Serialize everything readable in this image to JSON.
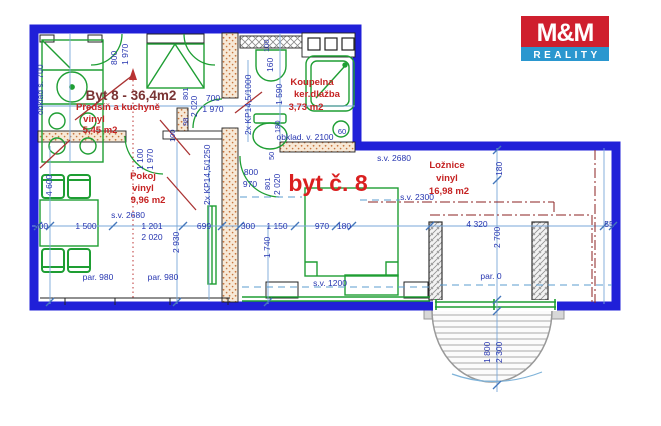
{
  "logo": {
    "brand": "M&M",
    "subtitle": "REALITY",
    "brand_bg": "#cf1f2e",
    "subtitle_bg": "#2a97cf"
  },
  "plan": {
    "title": "Byt 8 - 36,4m2",
    "unit_label": "byt č. 8",
    "rooms": [
      {
        "name": "Předsíň a kuchyně",
        "floor": "vinyl",
        "area": "5,45 m2"
      },
      {
        "name": "Koupelna",
        "floor": "ker.dlažba",
        "area": "3,73 m2"
      },
      {
        "name": "Pokoj",
        "floor": "vinyl",
        "area": "9,96 m2"
      },
      {
        "name": "Ložnice",
        "floor": "vinyl",
        "area": "16,98 m2"
      }
    ],
    "colors": {
      "outline_blue": "#2020d8",
      "furniture_green": "#1e9e33",
      "dimension_blue": "#2635b0",
      "room_label_red": "#c52323",
      "unit_label_red": "#da2020"
    },
    "labels": [
      {
        "n": "plan-title",
        "t": "Byt 8 - 36,4m2",
        "x": 131,
        "y": 100,
        "cls": "title",
        "a": "middle"
      },
      {
        "n": "room-hall-name",
        "t": "Předsíň a kuchyně",
        "x": 118,
        "y": 110,
        "cls": "room",
        "a": "middle"
      },
      {
        "n": "room-hall-floor",
        "t": "vinyl",
        "x": 94,
        "y": 122,
        "cls": "room",
        "a": "middle"
      },
      {
        "n": "room-hall-area",
        "t": "5,45 m2",
        "x": 100,
        "y": 133,
        "cls": "room",
        "a": "middle"
      },
      {
        "n": "room-bath-name",
        "t": "Koupelna",
        "x": 312,
        "y": 85,
        "cls": "room",
        "a": "middle"
      },
      {
        "n": "room-bath-floor",
        "t": "ker.dlažba",
        "x": 317,
        "y": 97,
        "cls": "room",
        "a": "middle"
      },
      {
        "n": "room-bath-area",
        "t": "3,73 m2",
        "x": 306,
        "y": 110,
        "cls": "room",
        "a": "middle"
      },
      {
        "n": "room-pokoj-name",
        "t": "Pokoj",
        "x": 143,
        "y": 179,
        "cls": "room",
        "a": "middle"
      },
      {
        "n": "room-pokoj-floor",
        "t": "vinyl",
        "x": 143,
        "y": 191,
        "cls": "room",
        "a": "middle"
      },
      {
        "n": "room-pokoj-area",
        "t": "9,96 m2",
        "x": 148,
        "y": 203,
        "cls": "room",
        "a": "middle"
      },
      {
        "n": "unit-label",
        "t": "byt č. 8",
        "x": 328,
        "y": 191,
        "cls": "unit",
        "a": "middle"
      },
      {
        "n": "room-loznice-name",
        "t": "Ložnice",
        "x": 447,
        "y": 168,
        "cls": "room",
        "a": "middle"
      },
      {
        "n": "room-loznice-floor",
        "t": "vinyl",
        "x": 447,
        "y": 181,
        "cls": "room",
        "a": "middle"
      },
      {
        "n": "room-loznice-area",
        "t": "16,98 m2",
        "x": 449,
        "y": 194,
        "cls": "room",
        "a": "middle"
      },
      {
        "n": "dim-label",
        "t": "700",
        "x": 213,
        "y": 101,
        "a": "middle"
      },
      {
        "n": "dim-label",
        "t": "1 970",
        "x": 213,
        "y": 112,
        "a": "middle"
      },
      {
        "n": "dim-label",
        "t": "obklad. v. 2100",
        "x": 305,
        "y": 140,
        "a": "middle"
      },
      {
        "n": "dim-label",
        "t": "s.v. 2680",
        "x": 128,
        "y": 218,
        "a": "middle"
      },
      {
        "n": "dim-label",
        "t": "300",
        "x": 41,
        "y": 229,
        "a": "middle"
      },
      {
        "n": "dim-label",
        "t": "1 500",
        "x": 86,
        "y": 229,
        "a": "middle"
      },
      {
        "n": "dim-label",
        "t": "1 201",
        "x": 152,
        "y": 229,
        "a": "middle"
      },
      {
        "n": "dim-label",
        "t": "2 020",
        "x": 152,
        "y": 240,
        "a": "middle"
      },
      {
        "n": "dim-label",
        "t": "699",
        "x": 204,
        "y": 229,
        "a": "middle"
      },
      {
        "n": "dim-label",
        "t": "300",
        "x": 248,
        "y": 229,
        "a": "middle"
      },
      {
        "n": "dim-label",
        "t": "1 150",
        "x": 277,
        "y": 229,
        "a": "middle"
      },
      {
        "n": "dim-label",
        "t": "970",
        "x": 322,
        "y": 229,
        "a": "middle"
      },
      {
        "n": "dim-label",
        "t": "180",
        "x": 344,
        "y": 229,
        "a": "middle"
      },
      {
        "n": "dim-label",
        "t": "par. 980",
        "x": 98,
        "y": 280,
        "a": "middle"
      },
      {
        "n": "dim-label",
        "t": "par. 980",
        "x": 163,
        "y": 280,
        "a": "middle"
      },
      {
        "n": "dim-label",
        "t": "800",
        "x": 251,
        "y": 175,
        "a": "middle"
      },
      {
        "n": "dim-label",
        "t": "970",
        "x": 250,
        "y": 187,
        "a": "middle"
      },
      {
        "n": "dim-label",
        "t": "s.v. 2680",
        "x": 394,
        "y": 161,
        "a": "middle"
      },
      {
        "n": "dim-label",
        "t": "s.v. 2300",
        "x": 417,
        "y": 200,
        "a": "middle"
      },
      {
        "n": "dim-label",
        "t": "4 320",
        "x": 477,
        "y": 227,
        "a": "middle"
      },
      {
        "n": "dim-label",
        "t": "55",
        "x": 609,
        "y": 227,
        "a": "middle"
      },
      {
        "n": "dim-label",
        "t": "par. 0",
        "x": 491,
        "y": 279,
        "a": "middle"
      },
      {
        "n": "dim-label",
        "t": "s.v. 1200",
        "x": 330,
        "y": 286,
        "a": "middle"
      },
      {
        "n": "dim-label",
        "t": "60",
        "x": 342,
        "y": 134,
        "a": "middle",
        "cls": "dimsm"
      },
      {
        "n": "dim-label",
        "t": "800",
        "x": 117,
        "y": 65,
        "r": -90
      },
      {
        "n": "dim-label",
        "t": "1 970",
        "x": 128,
        "y": 65,
        "r": -90
      },
      {
        "n": "dim-label",
        "t": "2 020",
        "x": 197,
        "y": 117,
        "r": -90
      },
      {
        "n": "dim-label",
        "t": "801",
        "x": 188,
        "y": 100,
        "r": -90,
        "cls": "dimsm"
      },
      {
        "n": "dim-label",
        "t": "98",
        "x": 188,
        "y": 126,
        "r": -90,
        "cls": "dimsm"
      },
      {
        "n": "dim-label",
        "t": "100",
        "x": 175,
        "y": 142,
        "r": -90,
        "cls": "dimsm"
      },
      {
        "n": "dim-label",
        "t": "100",
        "x": 269,
        "y": 52,
        "r": -90,
        "cls": "dimsm"
      },
      {
        "n": "dim-label",
        "t": "160",
        "x": 273,
        "y": 72,
        "r": -90
      },
      {
        "n": "dim-label",
        "t": "1 590",
        "x": 282,
        "y": 105,
        "r": -90
      },
      {
        "n": "dim-label",
        "t": "2x KP14,5/1000",
        "x": 251,
        "y": 135,
        "r": -90
      },
      {
        "n": "dim-label",
        "t": "180",
        "x": 280,
        "y": 133,
        "r": -90,
        "cls": "dimsm"
      },
      {
        "n": "dim-label",
        "t": "obklad š. 700",
        "x": 43,
        "y": 115,
        "r": -90
      },
      {
        "n": "dim-label",
        "t": "1 100",
        "x": 143,
        "y": 170,
        "r": -90
      },
      {
        "n": "dim-label",
        "t": "1 970",
        "x": 153,
        "y": 170,
        "r": -90
      },
      {
        "n": "dim-label",
        "t": "2x KP14,5/1250",
        "x": 210,
        "y": 205,
        "r": -90
      },
      {
        "n": "dim-label",
        "t": "4 600",
        "x": 52,
        "y": 196,
        "r": -90
      },
      {
        "n": "dim-label",
        "t": "2 930",
        "x": 179,
        "y": 253,
        "r": -90
      },
      {
        "n": "dim-label",
        "t": "1 740",
        "x": 270,
        "y": 258,
        "r": -90
      },
      {
        "n": "dim-label",
        "t": "50",
        "x": 274,
        "y": 160,
        "r": -90,
        "cls": "dimsm"
      },
      {
        "n": "dim-label",
        "t": "801",
        "x": 270,
        "y": 190,
        "r": -90,
        "cls": "dimsm"
      },
      {
        "n": "dim-label",
        "t": "2 020",
        "x": 280,
        "y": 195,
        "r": -90
      },
      {
        "n": "dim-label",
        "t": "180",
        "x": 502,
        "y": 176,
        "r": -90
      },
      {
        "n": "dim-label",
        "t": "2 700",
        "x": 500,
        "y": 248,
        "r": -90
      },
      {
        "n": "dim-label",
        "t": "1 800",
        "x": 490,
        "y": 363,
        "r": -90
      },
      {
        "n": "dim-label",
        "t": "2 300",
        "x": 502,
        "y": 363,
        "r": -90
      }
    ]
  }
}
